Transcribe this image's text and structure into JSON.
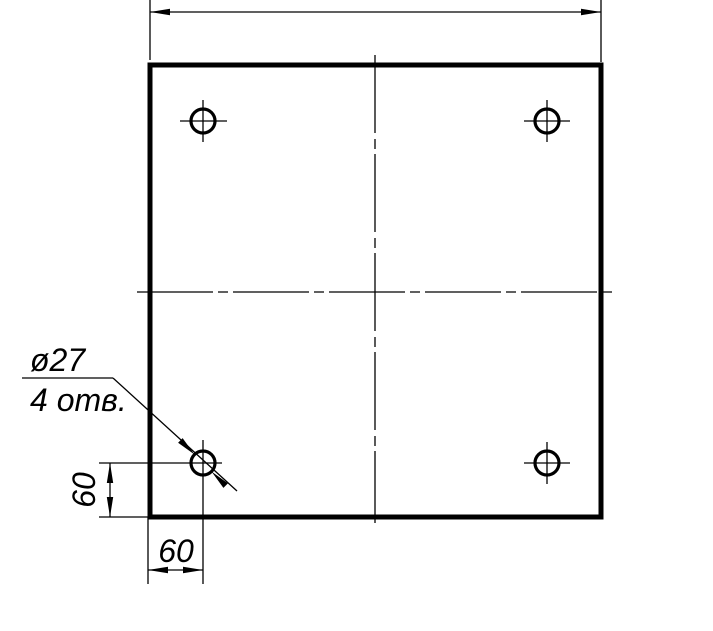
{
  "drawing": {
    "labels": {
      "hole_diameter": "ø27",
      "hole_count": "4 отв.",
      "dim_left": "60",
      "dim_bottom": "60"
    },
    "colors": {
      "line": "#000000",
      "background": "#ffffff"
    }
  }
}
